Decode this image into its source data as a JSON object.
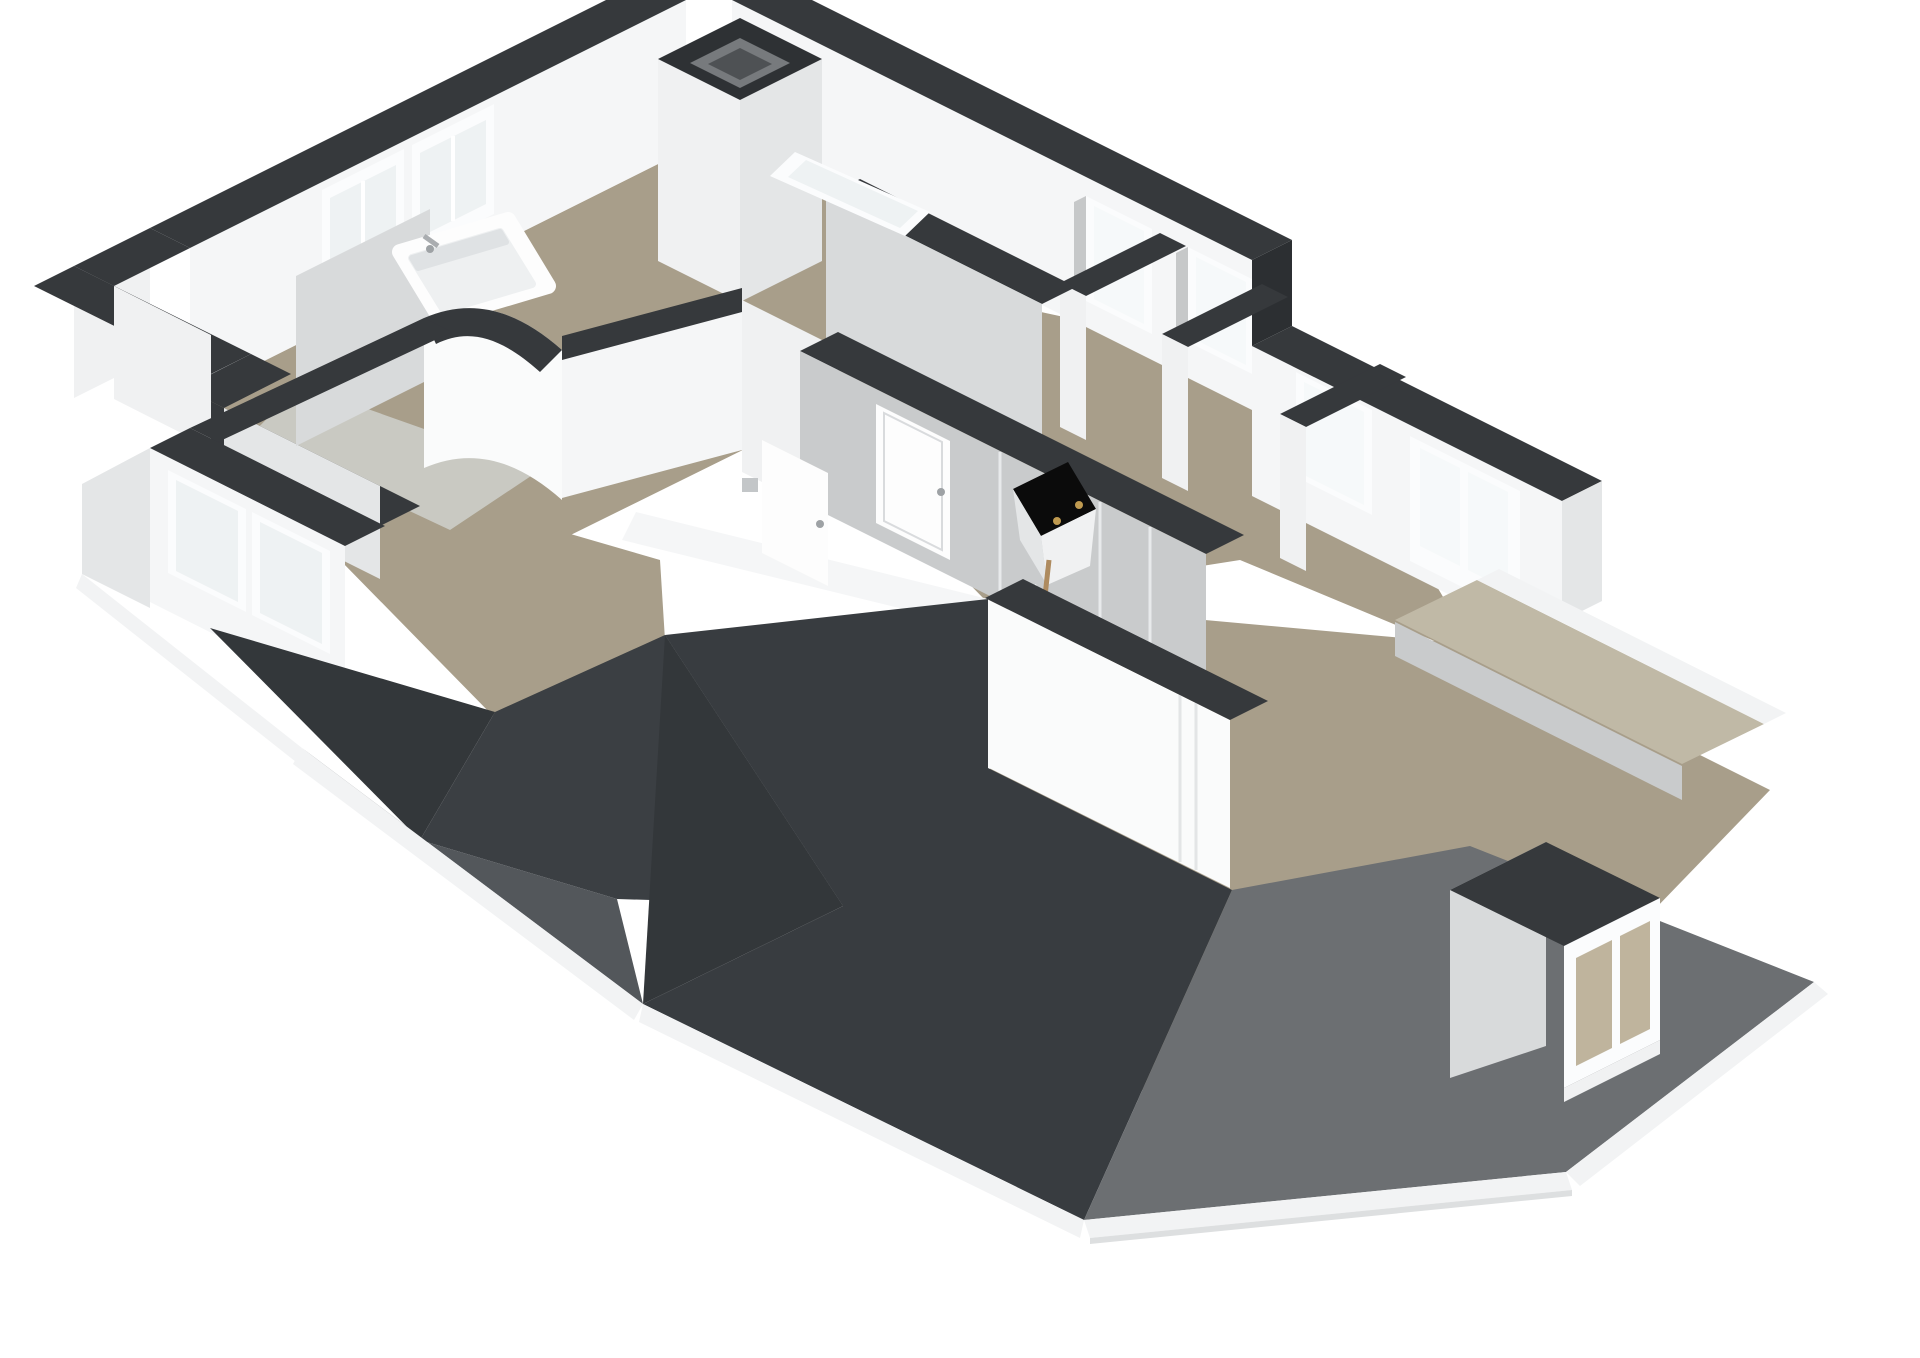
{
  "scene": {
    "kind": "3d-floorplan-render",
    "view": "axonometric-cutaway",
    "storey": "attic-floor",
    "background": "#ffffff"
  },
  "palette": {
    "cap": "#36393c",
    "capDeep": "#2c2f32",
    "wallWhite": "#f5f6f7",
    "wallBright": "#fafbfb",
    "wallFace": "#f0f1f2",
    "wallDim": "#e4e6e7",
    "wallShade": "#d8dadb",
    "wallGray": "#c9cbcc",
    "floor": "#a89e8a",
    "floorLight": "#b2a995",
    "floorPale": "#c9c9c2",
    "terrace": "#c0b9a6",
    "interiorTan": "#bfb49d",
    "roofDarkest": "#33373a",
    "roofDark": "#3b3f43",
    "roofMain": "#383c40",
    "roofSouth": "#53575b",
    "roofLight": "#6c6f72",
    "fascia": "#f2f3f4",
    "fasciaShade": "#dddfe0",
    "frame": "#fbfcfd",
    "glass": "#eef2f3",
    "glassBright": "#f6f9fa",
    "reveal": "#c6c8c9",
    "seam": "#e2e4e5",
    "doorWhite": "#fdfdfd",
    "doorSeam": "#d9dbdd",
    "chimneyRim": "#2e3134",
    "chimneyInner": "#777a7d",
    "chimneyCore": "#4e5154",
    "black": "#0b0b0b",
    "gold": "#bf9a50",
    "wood": "#ae8b5f",
    "chrome": "#aaadb0"
  },
  "inventory": {
    "rooms": [
      "bathroom",
      "toilet",
      "landing-hall",
      "bedroom-1",
      "bedroom-2",
      "bedroom-3",
      "attic-room",
      "roof-terrace"
    ],
    "objects": [
      "bathtub",
      "bath-faucet",
      "shower-mixer",
      "chimney-shaft",
      "propped-roof-window",
      "leaning-window-frame",
      "loft-hatch-black-panel",
      "brass-hinge-pins",
      "wooden-stringer",
      "interior-doors",
      "dormer-window"
    ],
    "window_count": 9,
    "door_count": 3,
    "roof_planes": 6
  }
}
